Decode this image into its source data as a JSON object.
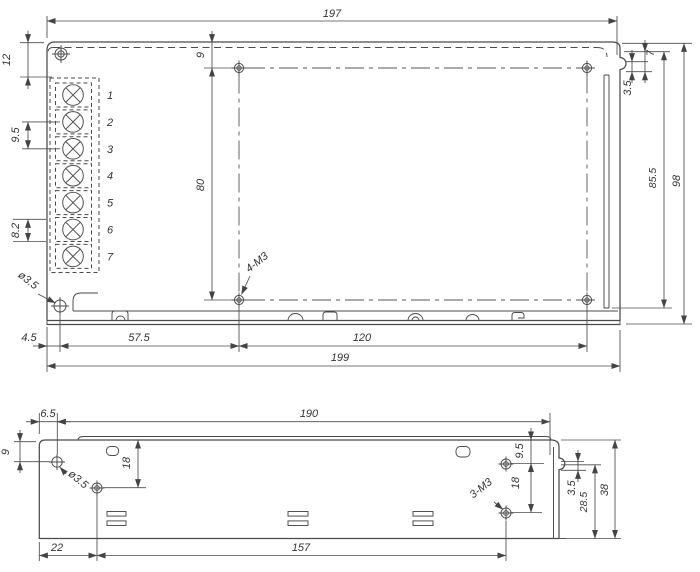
{
  "colors": {
    "background": "#ffffff",
    "line": "#4a4a4a",
    "dimension_line": "#4c4c4c",
    "text": "#333333"
  },
  "top_view": {
    "dims": {
      "overall_top": "197",
      "edge_to_block": "12",
      "terminal_pitch_a": "9.5",
      "terminal_pitch_b": "8.2",
      "corner_hole_dia": "ø3.5",
      "hole_offset_left": "4.5",
      "hole_span_left": "57.5",
      "hole_span_right": "120",
      "overall_bottom": "199",
      "hole_offset_top": "9",
      "hole_span_vertical": "80",
      "mounting_holes": "4-M3",
      "notch_offset": "7",
      "notch_depth": "3.5",
      "panel_height": "85.5",
      "overall_height": "98"
    },
    "terminals": [
      "1",
      "2",
      "3",
      "4",
      "5",
      "6",
      "7"
    ]
  },
  "side_view": {
    "dims": {
      "edge_to_hole": "6.5",
      "overall_top": "190",
      "hole_offset_top": "9",
      "hole_drop_left": "18",
      "hole_dia": "ø3.5",
      "edge_to_hole_bottom": "22",
      "hole_span_bottom": "157",
      "hole_offset_right": "9.5",
      "hole_span_right": "18",
      "mounting_holes": "3-M3",
      "notch_depth": "3.5",
      "hole_to_base": "28.5",
      "overall_height": "38"
    }
  }
}
